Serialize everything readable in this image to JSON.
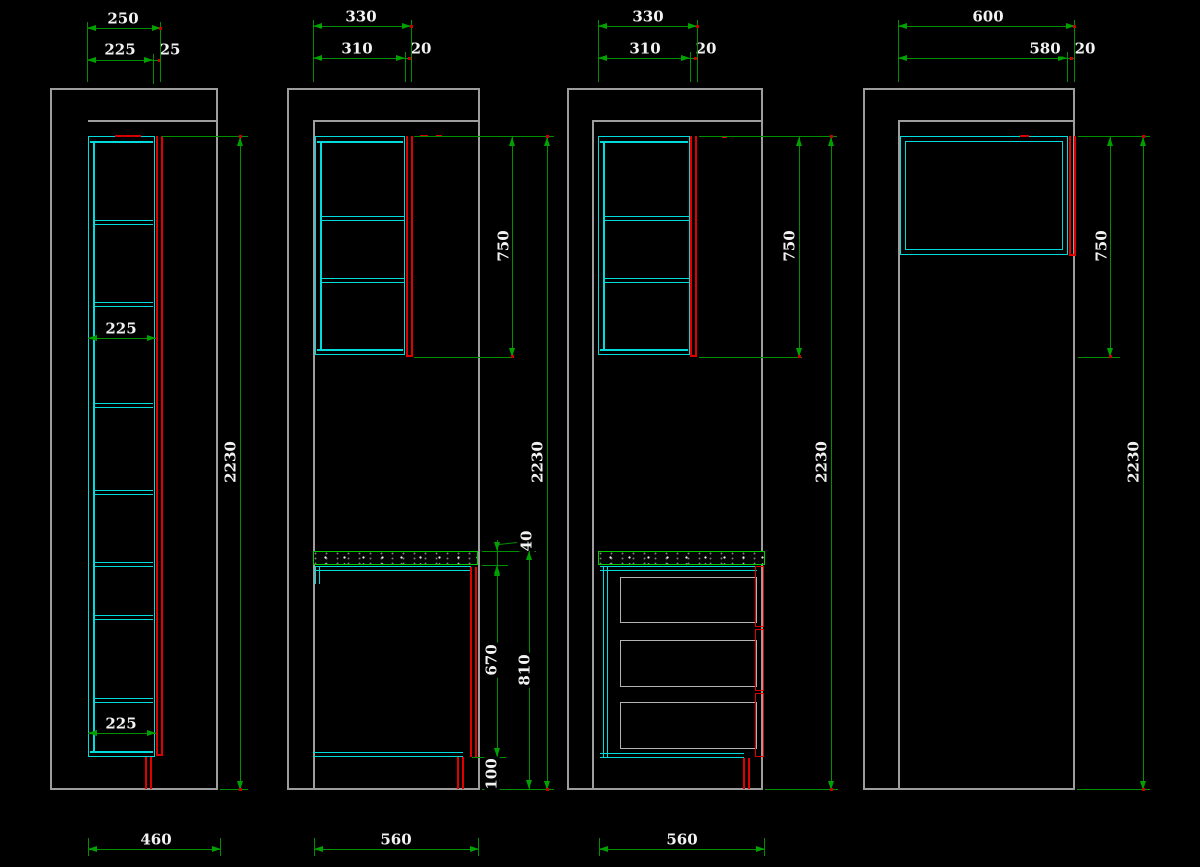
{
  "drawing": {
    "type": "kitchen cabinet elevation sections (CAD)",
    "colors": {
      "background": "#000000",
      "wall_outline": "#9d9d9d",
      "cabinet_line": "#00dcdc",
      "door_edge": "#e00000",
      "countertop": "#00ce00",
      "dimension_line": "#008f00",
      "dimension_text": "#f2f2f2",
      "drawer_outline": "#b4b4b4"
    }
  },
  "sections": [
    {
      "id": "section-1",
      "dims": {
        "overall_width": "250",
        "cabinet_width": "225",
        "door_thickness": "25",
        "interior_width_upper": "225",
        "interior_width_lower": "225",
        "total_height": "2230",
        "floor_width": "460"
      }
    },
    {
      "id": "section-2",
      "dims": {
        "overall_width": "330",
        "cabinet_width": "310",
        "door_thickness": "20",
        "wall_cabinet_height": "750",
        "total_height": "2230",
        "countertop_thickness": "40",
        "base_cabinet_height": "670",
        "worktop_height": "810",
        "plinth_height": "100",
        "floor_width": "560"
      }
    },
    {
      "id": "section-3",
      "dims": {
        "overall_width": "330",
        "cabinet_width": "310",
        "door_thickness": "20",
        "wall_cabinet_height": "750",
        "total_height": "2230",
        "floor_width": "560"
      }
    },
    {
      "id": "section-4",
      "dims": {
        "overall_width": "600",
        "cabinet_width": "580",
        "door_thickness": "20",
        "wall_cabinet_height": "750",
        "total_height": "2230"
      }
    }
  ]
}
